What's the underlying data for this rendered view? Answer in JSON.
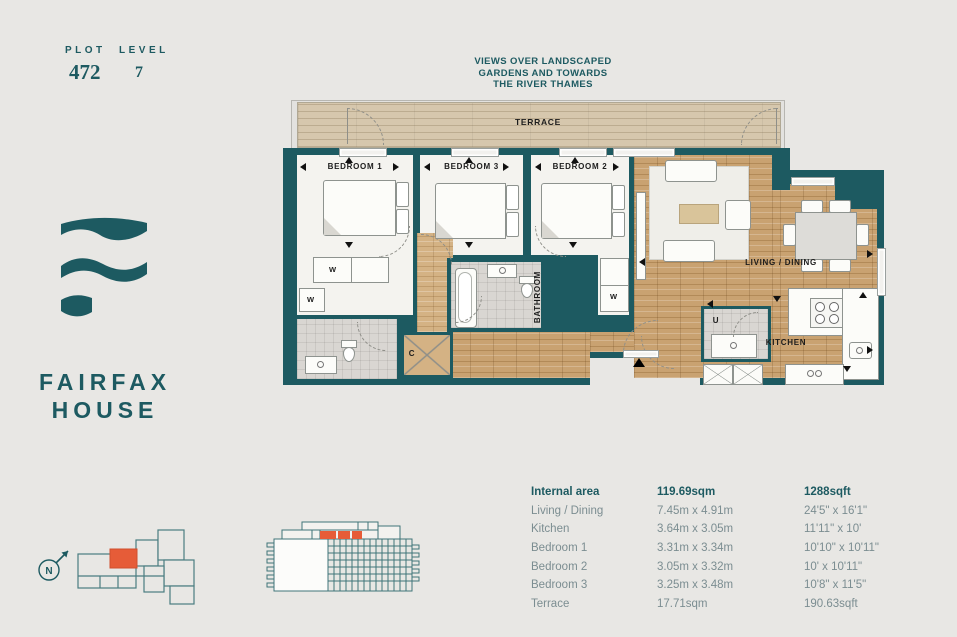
{
  "header": {
    "plot_label": "PLOT",
    "plot_value": "472",
    "level_label": "LEVEL",
    "level_value": "7"
  },
  "brand": {
    "line1": "FAIRFAX",
    "line2": "HOUSE"
  },
  "views_note": {
    "line1": "VIEWS OVER LANDSCAPED",
    "line2": "GARDENS AND TOWARDS",
    "line3": "THE RIVER THAMES"
  },
  "plan": {
    "terrace": "TERRACE",
    "bedroom1": "BEDROOM 1",
    "bedroom2": "BEDROOM 2",
    "bedroom3": "BEDROOM 3",
    "living": "LIVING / DINING",
    "kitchen": "KITCHEN",
    "bathroom": "BATHROOM",
    "wardrobe": "W",
    "cupboard": "C",
    "utility": "U"
  },
  "compass": {
    "north": "N"
  },
  "colors": {
    "teal": "#1d5a61",
    "orange": "#e65c38"
  },
  "areas": {
    "header": {
      "name": "Internal area",
      "metric": "119.69sqm",
      "imperial": "1288sqft"
    },
    "rows": [
      {
        "name": "Living / Dining",
        "metric": "7.45m x 4.91m",
        "imperial": "24'5\" x 16'1\""
      },
      {
        "name": "Kitchen",
        "metric": "3.64m x 3.05m",
        "imperial": "11'11\" x 10'"
      },
      {
        "name": "Bedroom 1",
        "metric": "3.31m x 3.34m",
        "imperial": "10'10\" x 10'11\""
      },
      {
        "name": "Bedroom 2",
        "metric": "3.05m x 3.32m",
        "imperial": "10' x 10'11\""
      },
      {
        "name": "Bedroom 3",
        "metric": "3.25m x 3.48m",
        "imperial": "10'8\" x 11'5\""
      },
      {
        "name": "Terrace",
        "metric": "17.71sqm",
        "imperial": "190.63sqft"
      }
    ]
  }
}
